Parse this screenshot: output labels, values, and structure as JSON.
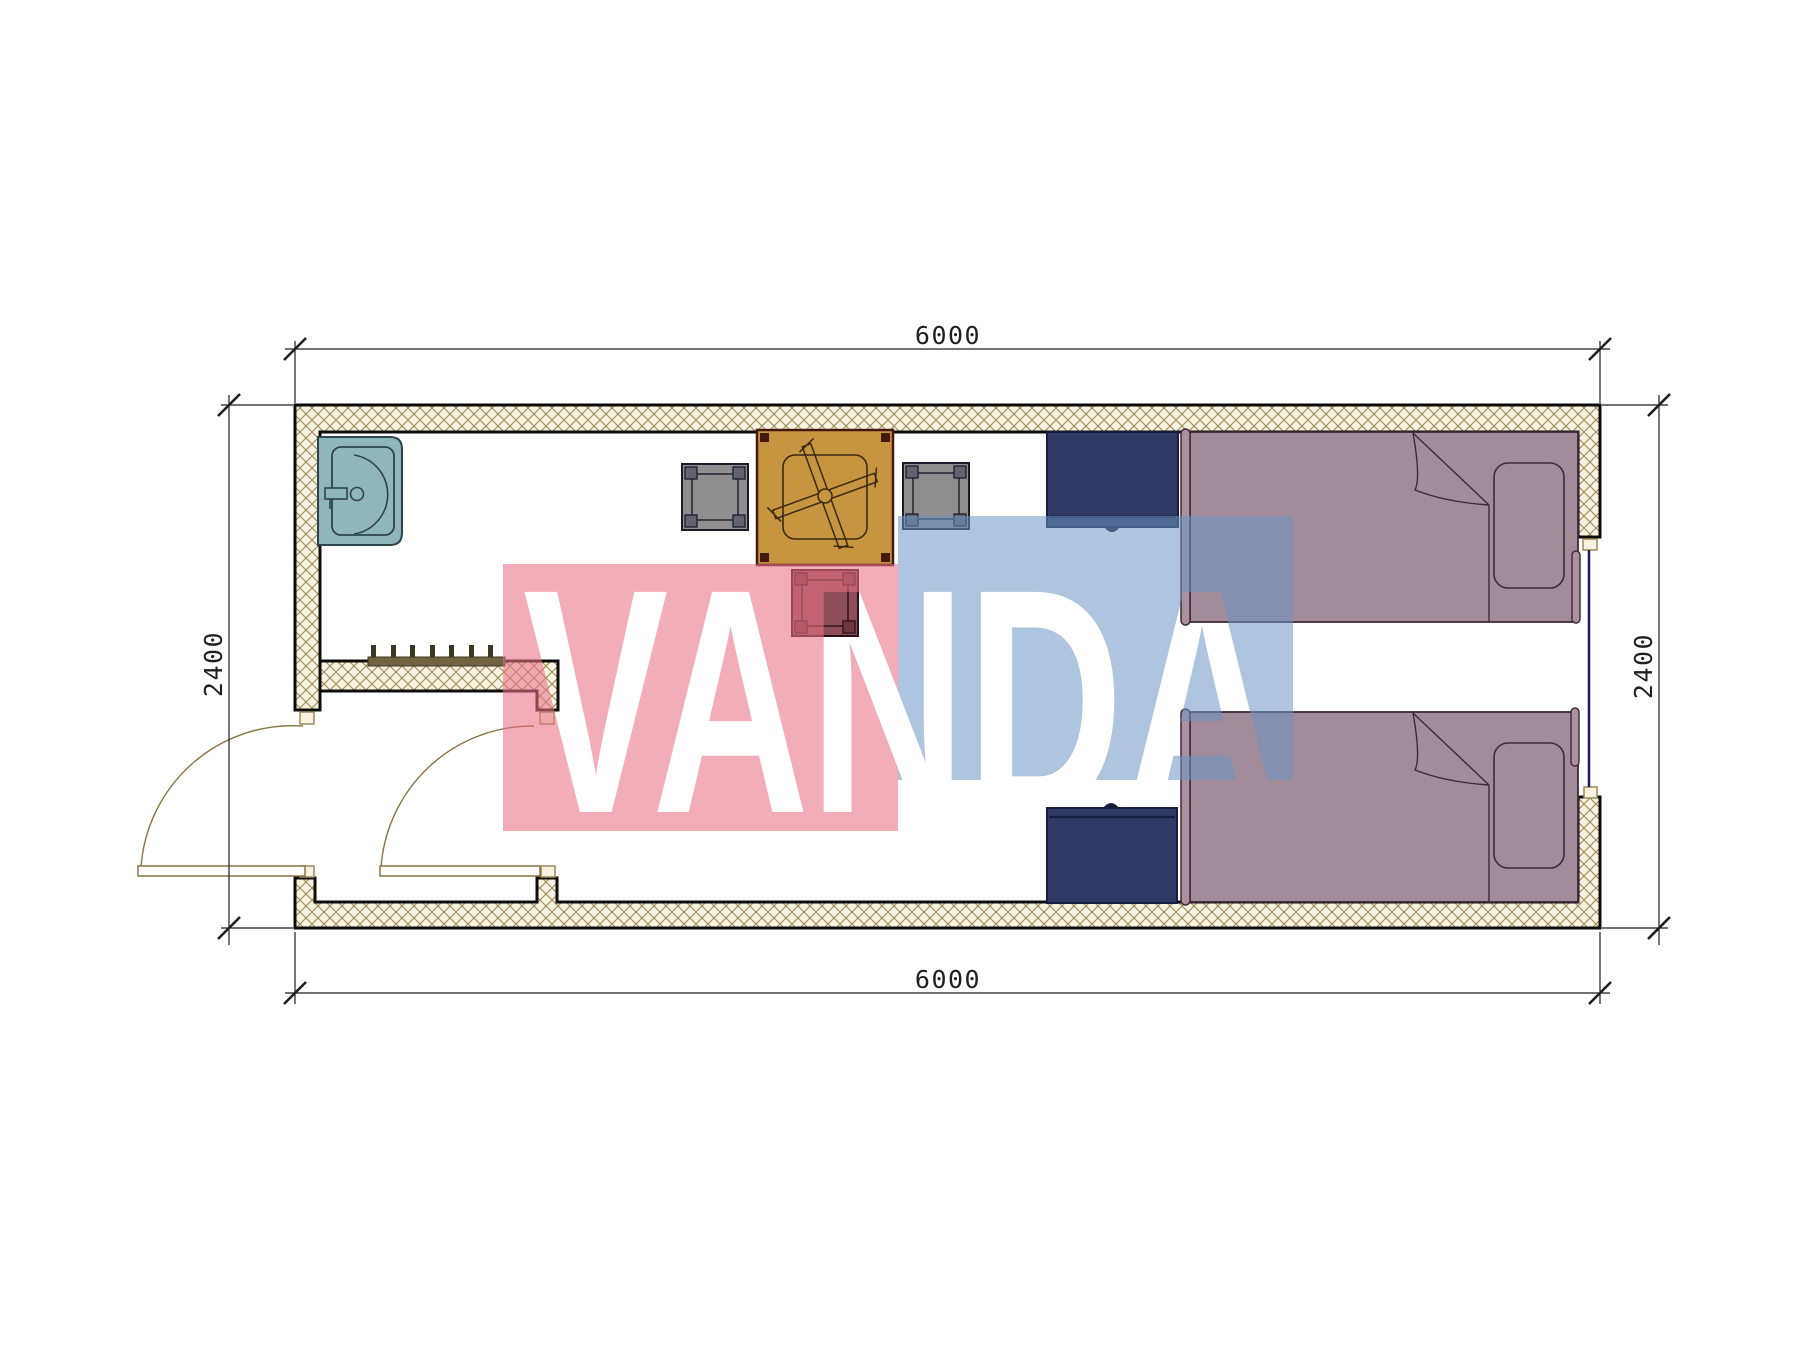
{
  "dimensions": {
    "top": "6000",
    "bottom": "6000",
    "left": "2400",
    "right": "2400"
  },
  "watermark": {
    "text": "VANDA"
  },
  "colors": {
    "wall-line": "#0d0d0d",
    "hatch-bg": "#f8f3e1",
    "hatch-line": "#9b8b56",
    "sink": "#8fb6bd",
    "sink-line": "#2c444c",
    "table": "#c79440",
    "table-line": "#45190f",
    "stool-gray": "#8f8f8f",
    "stool-gray-accent": "#5f6470",
    "stool-maroon": "#8d4e59",
    "stool-maroon-accent": "#6e3842",
    "cabinet": "#2e3a63",
    "cabinet-line": "#151e3d",
    "bed": "#a28c9a",
    "bed-line": "#3f2838",
    "headboard": "#ab91a0",
    "door": "#8a7344",
    "window": "#1b1b60",
    "rack": "#6f6340",
    "rack-dark": "#3c3722",
    "dim": "#1f1f1f",
    "wm-pink": "#e87286",
    "wm-blue": "#6e93c3"
  },
  "furniture": [
    "wash-basin",
    "coat-rack",
    "square-table",
    "stool",
    "stool",
    "stool",
    "bedside-cabinet",
    "bedside-cabinet",
    "single-bed",
    "single-bed",
    "entry-door",
    "inner-door",
    "window"
  ]
}
